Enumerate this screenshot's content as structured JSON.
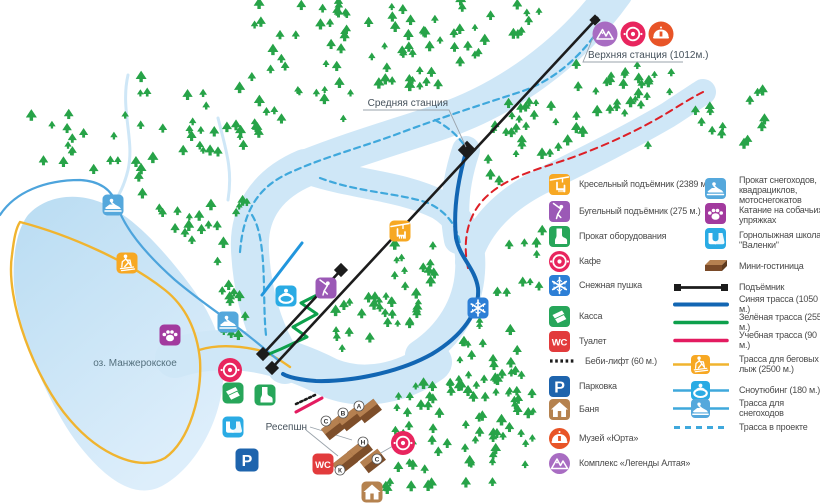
{
  "map": {
    "stations": {
      "upper": "Верхняя станция  (1012м.)",
      "middle": "Средняя станция"
    },
    "lake_label": "оз. Манжерокское",
    "reception_label": "Ресепшн",
    "cabin_letters": [
      "С",
      "В",
      "А",
      "Н",
      "К",
      "С"
    ]
  },
  "glyphs": {
    "wc": "WC",
    "parking": "P"
  },
  "legend": {
    "facilities": [
      {
        "label": "Кресельный подъёмник (2389 м.)",
        "icon": "chairlift-icon",
        "color": "#f7a823"
      },
      {
        "label": "Бугельный подъёмник (275 м.)",
        "icon": "tbar-lift-icon",
        "color": "#9b59b6"
      },
      {
        "label": "Прокат оборудования",
        "icon": "equipment-rental-icon",
        "color": "#27a65a"
      },
      {
        "label": "Кафе",
        "icon": "cafe-icon",
        "color": "#e8255e"
      },
      {
        "label": "Снежная пушка",
        "icon": "snow-cannon-icon",
        "color": "#2d7fd6"
      },
      {
        "label": "Касса",
        "icon": "ticket-office-icon",
        "color": "#27a65a"
      },
      {
        "label": "Туалет",
        "icon": "wc-icon",
        "color": "#e23b3c"
      },
      {
        "label": "Беби-лифт (60 м.)",
        "icon": "baby-lift-line",
        "color": "#1c1c1c"
      },
      {
        "label": "Парковка",
        "icon": "parking-icon",
        "color": "#1e64ad"
      },
      {
        "label": "Баня",
        "icon": "banya-icon",
        "color": "#b5824f"
      },
      {
        "label": "Музей «Юрта»",
        "icon": "yurt-museum-icon",
        "color": "#e85427"
      },
      {
        "label": "Комплекс «Легенды Алтая»",
        "icon": "altai-legends-icon",
        "color": "#a86cc2"
      }
    ],
    "services": [
      {
        "label": "Прокат снегоходов, квадрациклов, мотоснегокатов",
        "icon": "snowmobile-icon",
        "color": "#55a8dc"
      },
      {
        "label": "Катание на собачьих упряжках",
        "icon": "dog-sled-icon",
        "color": "#a23a9e"
      },
      {
        "label": "Горнолыжная школа \"Валенки\"",
        "icon": "ski-school-icon",
        "color": "#2aabe4"
      },
      {
        "label": "Мини-гостиница",
        "icon": "mini-hotel-icon",
        "color": "#7a4a28"
      }
    ],
    "trails": [
      {
        "label": "Подъёмник",
        "style": "black-line",
        "color": "#1c1c1c"
      },
      {
        "label": "Синяя трасса (1050 м.)",
        "style": "solid",
        "color": "#1266b3"
      },
      {
        "label": "Зелёная трасса (255 м.)",
        "style": "solid",
        "color": "#0da04c"
      },
      {
        "label": "Учебная трасса (90 м.)",
        "style": "solid",
        "color": "#e31b60"
      },
      {
        "label": "Трасса для беговых лыж (2500 м.)",
        "style": "solid-with-icon",
        "color": "#f0b42f"
      },
      {
        "label": "Сноутюбинг (180 м.)",
        "style": "solid-with-icon",
        "color": "#3fa8dc"
      },
      {
        "label": "Трасса для снегоходов",
        "style": "solid-with-icon",
        "color": "#3fa8dc"
      },
      {
        "label": "Трасса в проекте",
        "style": "dashed",
        "color": "#3fa8dc"
      }
    ]
  },
  "colors": {
    "water_band": "#cfe7f7",
    "lake_top": "#b9dcf2",
    "lake_bottom": "#ddeefb",
    "tree_green": "#27a348",
    "lift_black": "#1c1c1c",
    "blue_trail": "#1266b3",
    "green_trail": "#0da04c",
    "training_trail": "#e31b60",
    "xc_trail_yellow": "#f0b42f",
    "project_trail_dash": "#3fa8dc",
    "red_dash": "#dd1f26"
  }
}
